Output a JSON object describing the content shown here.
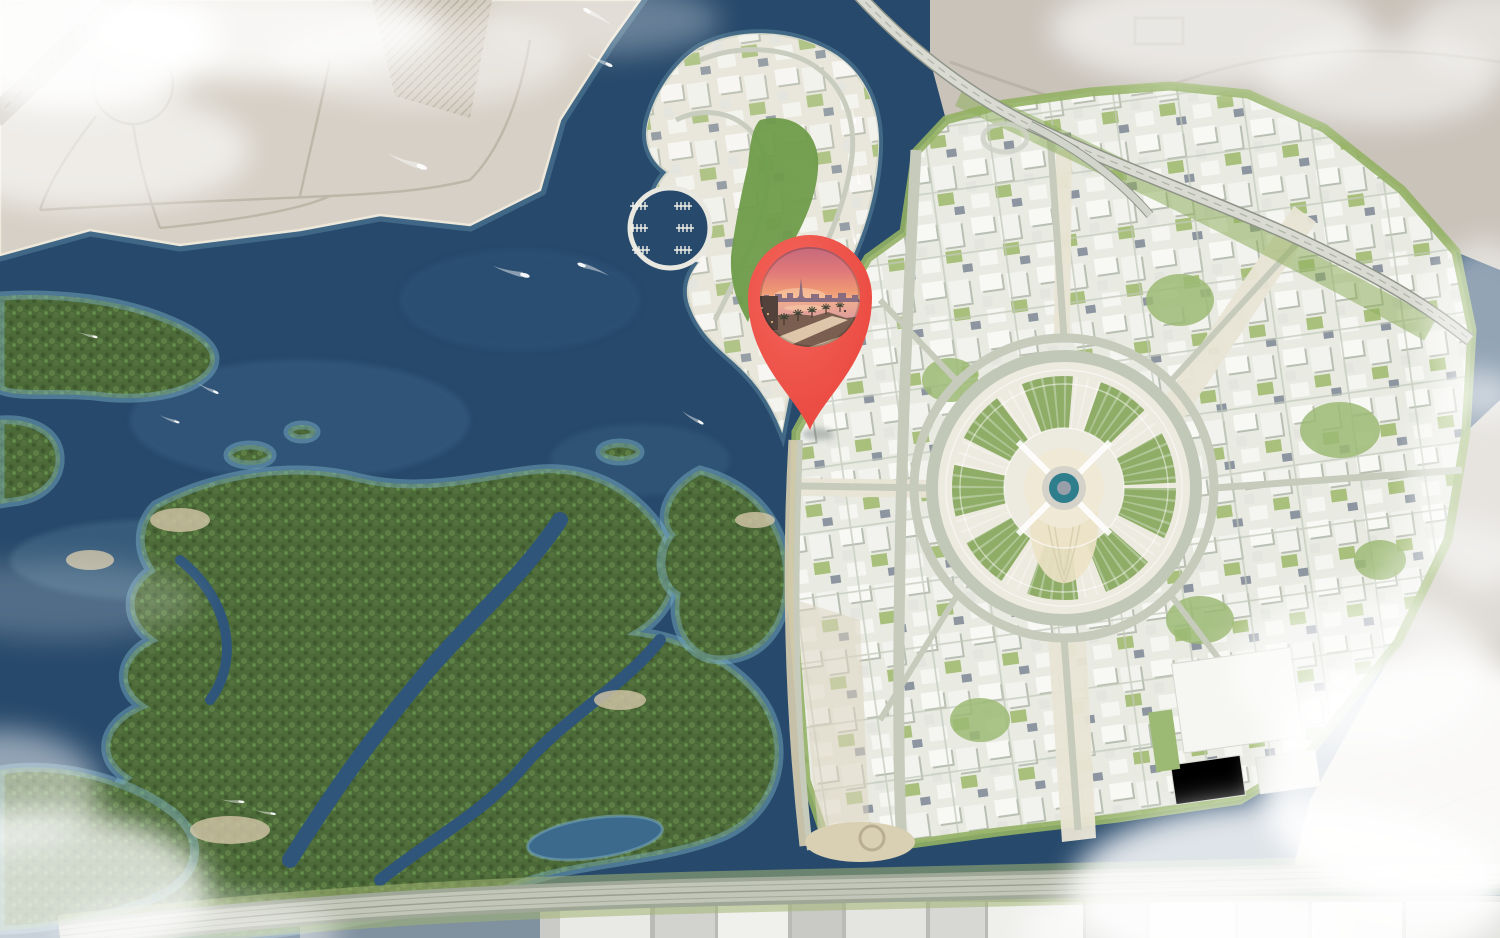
{
  "map": {
    "kind": "aerial-3d-masterplan-render",
    "marker": {
      "icon": "location-pin-icon",
      "fill": "#e8443b",
      "fill_light": "#f4655b",
      "tip_x": 810,
      "tip_y": 430,
      "photo": "sunset waterfront promenade with palm trees and city skyline"
    },
    "colors": {
      "sea": "#27496b",
      "sea_shallow": "#7fb3c8",
      "sand": "#d6d0c6",
      "desert": "#c9c3ba",
      "mangrove": "#4c6a38",
      "city_base": "#e9ebe3",
      "city_green": "#93b164",
      "road": "#c6cbbc",
      "plaza_teal": "#2e7e8e",
      "cloud": "#ffffff",
      "photo_sky_top": "#c4687c",
      "photo_sky_horizon": "#f6bd92",
      "photo_water": "#d898a0"
    },
    "boats_visible": 12
  }
}
